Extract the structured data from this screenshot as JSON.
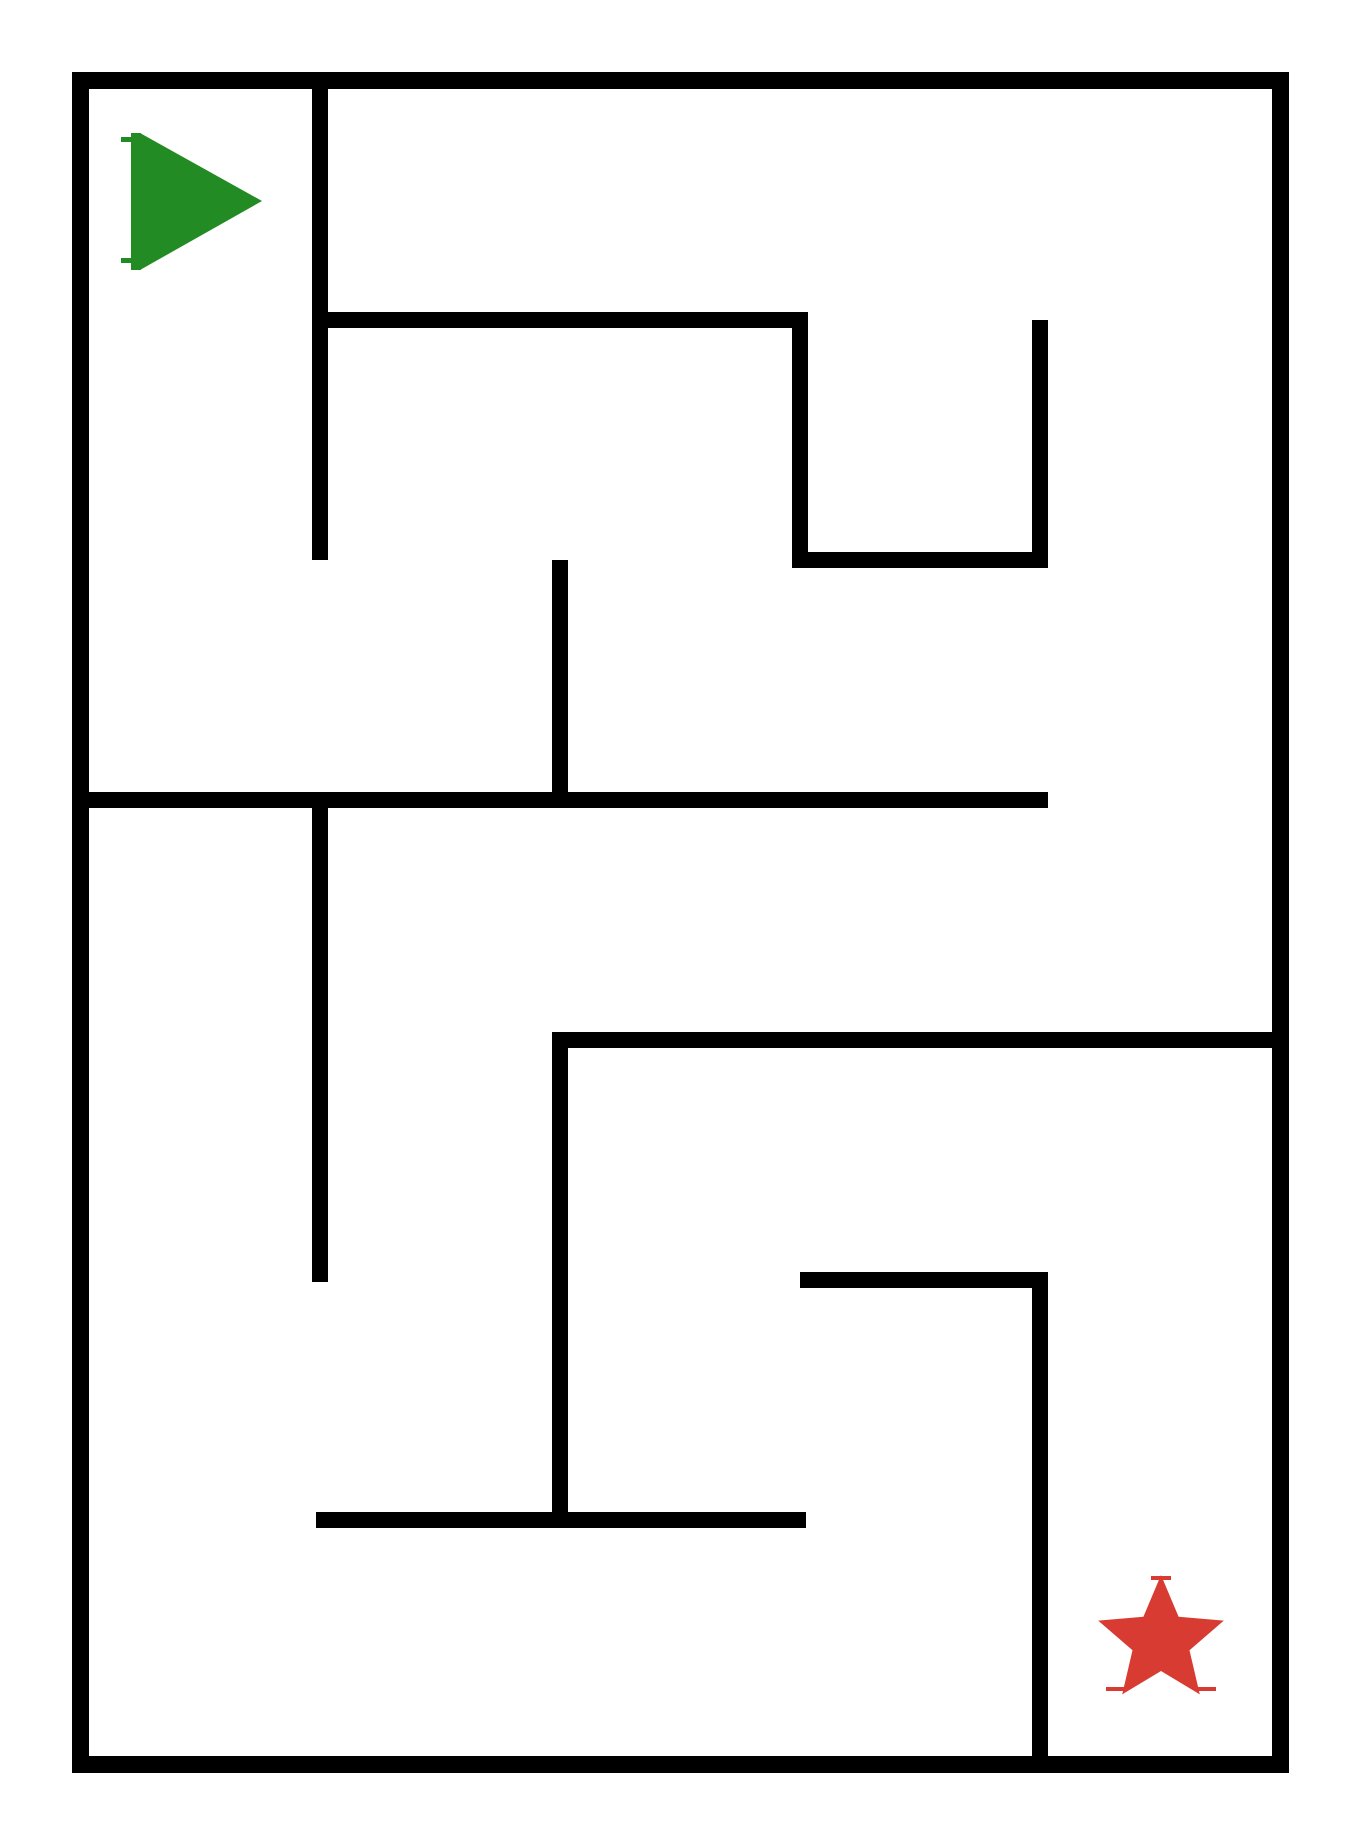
{
  "canvas": {
    "width": 1360,
    "height": 1840,
    "background": "#ffffff"
  },
  "maze": {
    "wall_color": "#000000",
    "grid": {
      "columns": 5,
      "rows": 7,
      "cell_size": 240,
      "origin_x": 80,
      "origin_y": 80,
      "wall_thickness": 16,
      "border_thickness": 17
    },
    "walls": [
      {
        "name": "border-top",
        "x": 72,
        "y": 72,
        "w": 1217,
        "h": 17
      },
      {
        "name": "border-bottom",
        "x": 72,
        "y": 1756,
        "w": 1217,
        "h": 17
      },
      {
        "name": "border-left",
        "x": 72,
        "y": 72,
        "w": 17,
        "h": 1701
      },
      {
        "name": "border-right",
        "x": 1272,
        "y": 72,
        "w": 17,
        "h": 1701
      },
      {
        "name": "wall-v1",
        "x": 312,
        "y": 80,
        "w": 16,
        "h": 480
      },
      {
        "name": "wall-h1",
        "x": 312,
        "y": 312,
        "w": 496,
        "h": 16
      },
      {
        "name": "wall-v2",
        "x": 792,
        "y": 312,
        "w": 16,
        "h": 248
      },
      {
        "name": "wall-h2",
        "x": 792,
        "y": 552,
        "w": 256,
        "h": 16
      },
      {
        "name": "wall-v3",
        "x": 1032,
        "y": 320,
        "w": 16,
        "h": 248
      },
      {
        "name": "wall-v4",
        "x": 552,
        "y": 560,
        "w": 16,
        "h": 248
      },
      {
        "name": "wall-h3",
        "x": 80,
        "y": 792,
        "w": 968,
        "h": 16
      },
      {
        "name": "wall-v5",
        "x": 312,
        "y": 800,
        "w": 16,
        "h": 482
      },
      {
        "name": "wall-h4",
        "x": 552,
        "y": 1032,
        "w": 728,
        "h": 16
      },
      {
        "name": "wall-v6",
        "x": 552,
        "y": 1040,
        "w": 16,
        "h": 488
      },
      {
        "name": "wall-h5",
        "x": 800,
        "y": 1272,
        "w": 248,
        "h": 16
      },
      {
        "name": "wall-v7",
        "x": 1032,
        "y": 1280,
        "w": 16,
        "h": 484
      },
      {
        "name": "wall-h6",
        "x": 316,
        "y": 1512,
        "w": 490,
        "h": 16
      }
    ]
  },
  "start_marker": {
    "shape": "right-pointing-triangle",
    "color": "#238B23",
    "cell": {
      "column": 0,
      "row": 0
    },
    "polygon": [
      [
        140,
        133
      ],
      [
        140,
        270
      ],
      [
        262,
        201
      ]
    ],
    "stem": {
      "x": 131,
      "y": 133,
      "w": 10,
      "h": 137
    },
    "ticks": [
      {
        "x": 121,
        "y": 137,
        "w": 12,
        "h": 5
      },
      {
        "x": 121,
        "y": 258,
        "w": 12,
        "h": 5
      }
    ]
  },
  "goal_marker": {
    "shape": "five-point-star",
    "color": "#D73B32",
    "cell": {
      "column": 4,
      "row": 6
    },
    "cx": 1161,
    "cy": 1641,
    "outer_radius": 66,
    "inner_radius": 30,
    "rotation_deg": -90,
    "ticks": [
      {
        "x": 1151,
        "y": 1576,
        "w": 20,
        "h": 4
      },
      {
        "x": 1106,
        "y": 1687,
        "w": 22,
        "h": 4
      },
      {
        "x": 1194,
        "y": 1687,
        "w": 22,
        "h": 4
      }
    ]
  }
}
